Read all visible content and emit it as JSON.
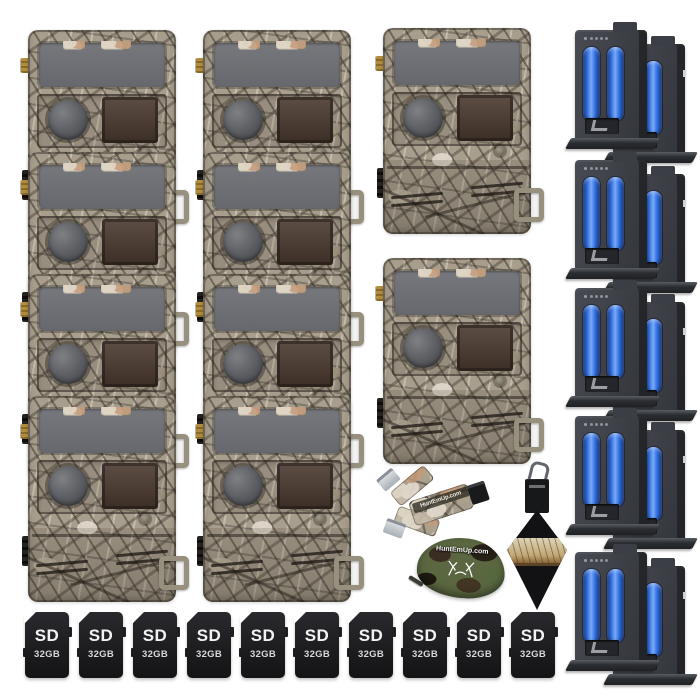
{
  "canvas": {
    "width": 700,
    "height": 700,
    "background": "#ffffff"
  },
  "cameras": {
    "stack_left_count": 4,
    "stack_center_count": 4,
    "middle_count": 2,
    "finish": "tree camouflage"
  },
  "batteries": {
    "group_count": 5,
    "packs_per_group": 2,
    "cells_per_pack": 2,
    "cell_color": "#2e6ee2"
  },
  "sd_card": {
    "label": "SD",
    "capacity": "32GB",
    "count": 10
  },
  "accessories": {
    "card_reader": {
      "brand": "HuntEmUp.com"
    },
    "zip_pouch": {
      "brand": "HuntEmUp.com"
    },
    "lens_cloth": {
      "color": "black"
    }
  },
  "colors": {
    "camo_base": "#a89e8d",
    "panel_gray": "#6e7074",
    "flash_brown": "#46382f",
    "battery_body": "#3c3f45",
    "sd_black": "#1c1c1f"
  }
}
